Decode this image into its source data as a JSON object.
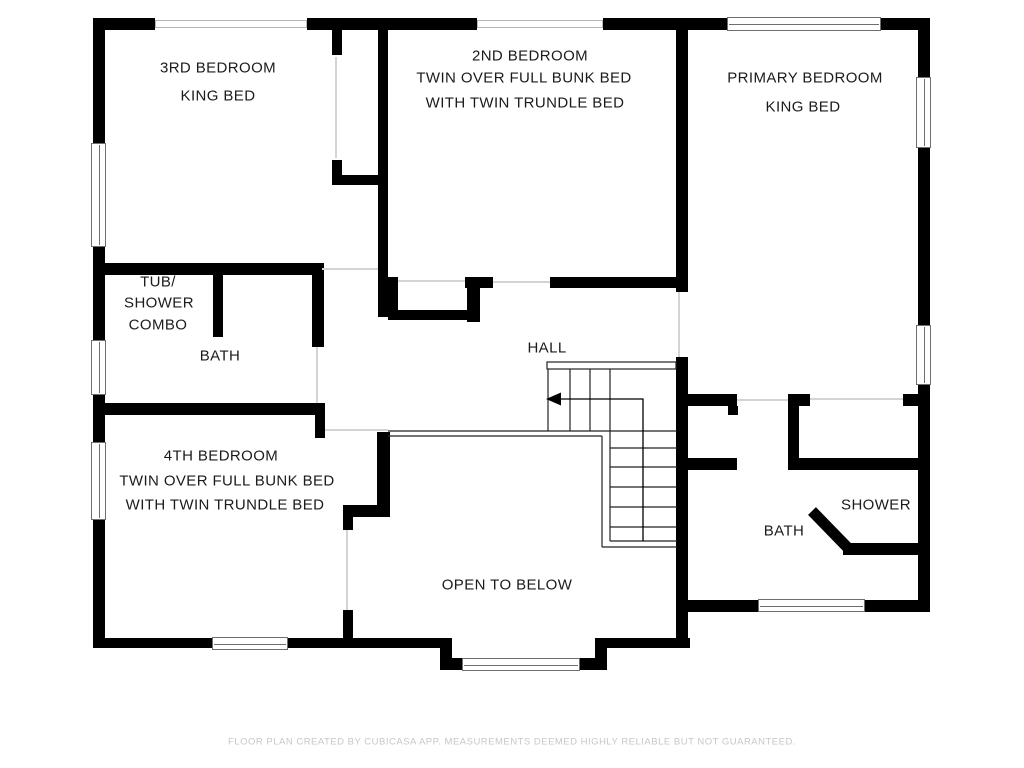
{
  "plan_title": "Upper floor plan",
  "colors": {
    "wall": "#000000",
    "label_text": "#1b1b1b",
    "window_frame": "#6e6e6e",
    "door_line": "#d4d4d4",
    "footer_text": "#c7c7c7",
    "background": "#ffffff"
  },
  "rooms": {
    "bedroom3": {
      "name": "3RD BEDROOM",
      "bed": "KING BED"
    },
    "bedroom2": {
      "name": "2ND BEDROOM",
      "bed1": "TWIN OVER FULL BUNK BED",
      "bed2": "WITH TWIN TRUNDLE BED"
    },
    "primary": {
      "name": "PRIMARY BEDROOM",
      "bed": "KING BED"
    },
    "tub_shower_combo": {
      "line1": "TUB/",
      "line2": "SHOWER",
      "line3": "COMBO"
    },
    "bath_upper": {
      "name": "BATH"
    },
    "bedroom4": {
      "name": "4TH BEDROOM",
      "bed1": "TWIN OVER FULL BUNK BED",
      "bed2": "WITH TWIN TRUNDLE BED"
    },
    "hall": {
      "name": "HALL"
    },
    "open_to_below": {
      "name": "OPEN TO BELOW"
    },
    "bath_lower": {
      "name": "BATH",
      "shower": "SHOWER"
    }
  },
  "footer": {
    "disclaimer": "FLOOR PLAN CREATED BY CUBICASA APP. MEASUREMENTS DEEMED HIGHLY RELIABLE BUT NOT GUARANTEED."
  }
}
